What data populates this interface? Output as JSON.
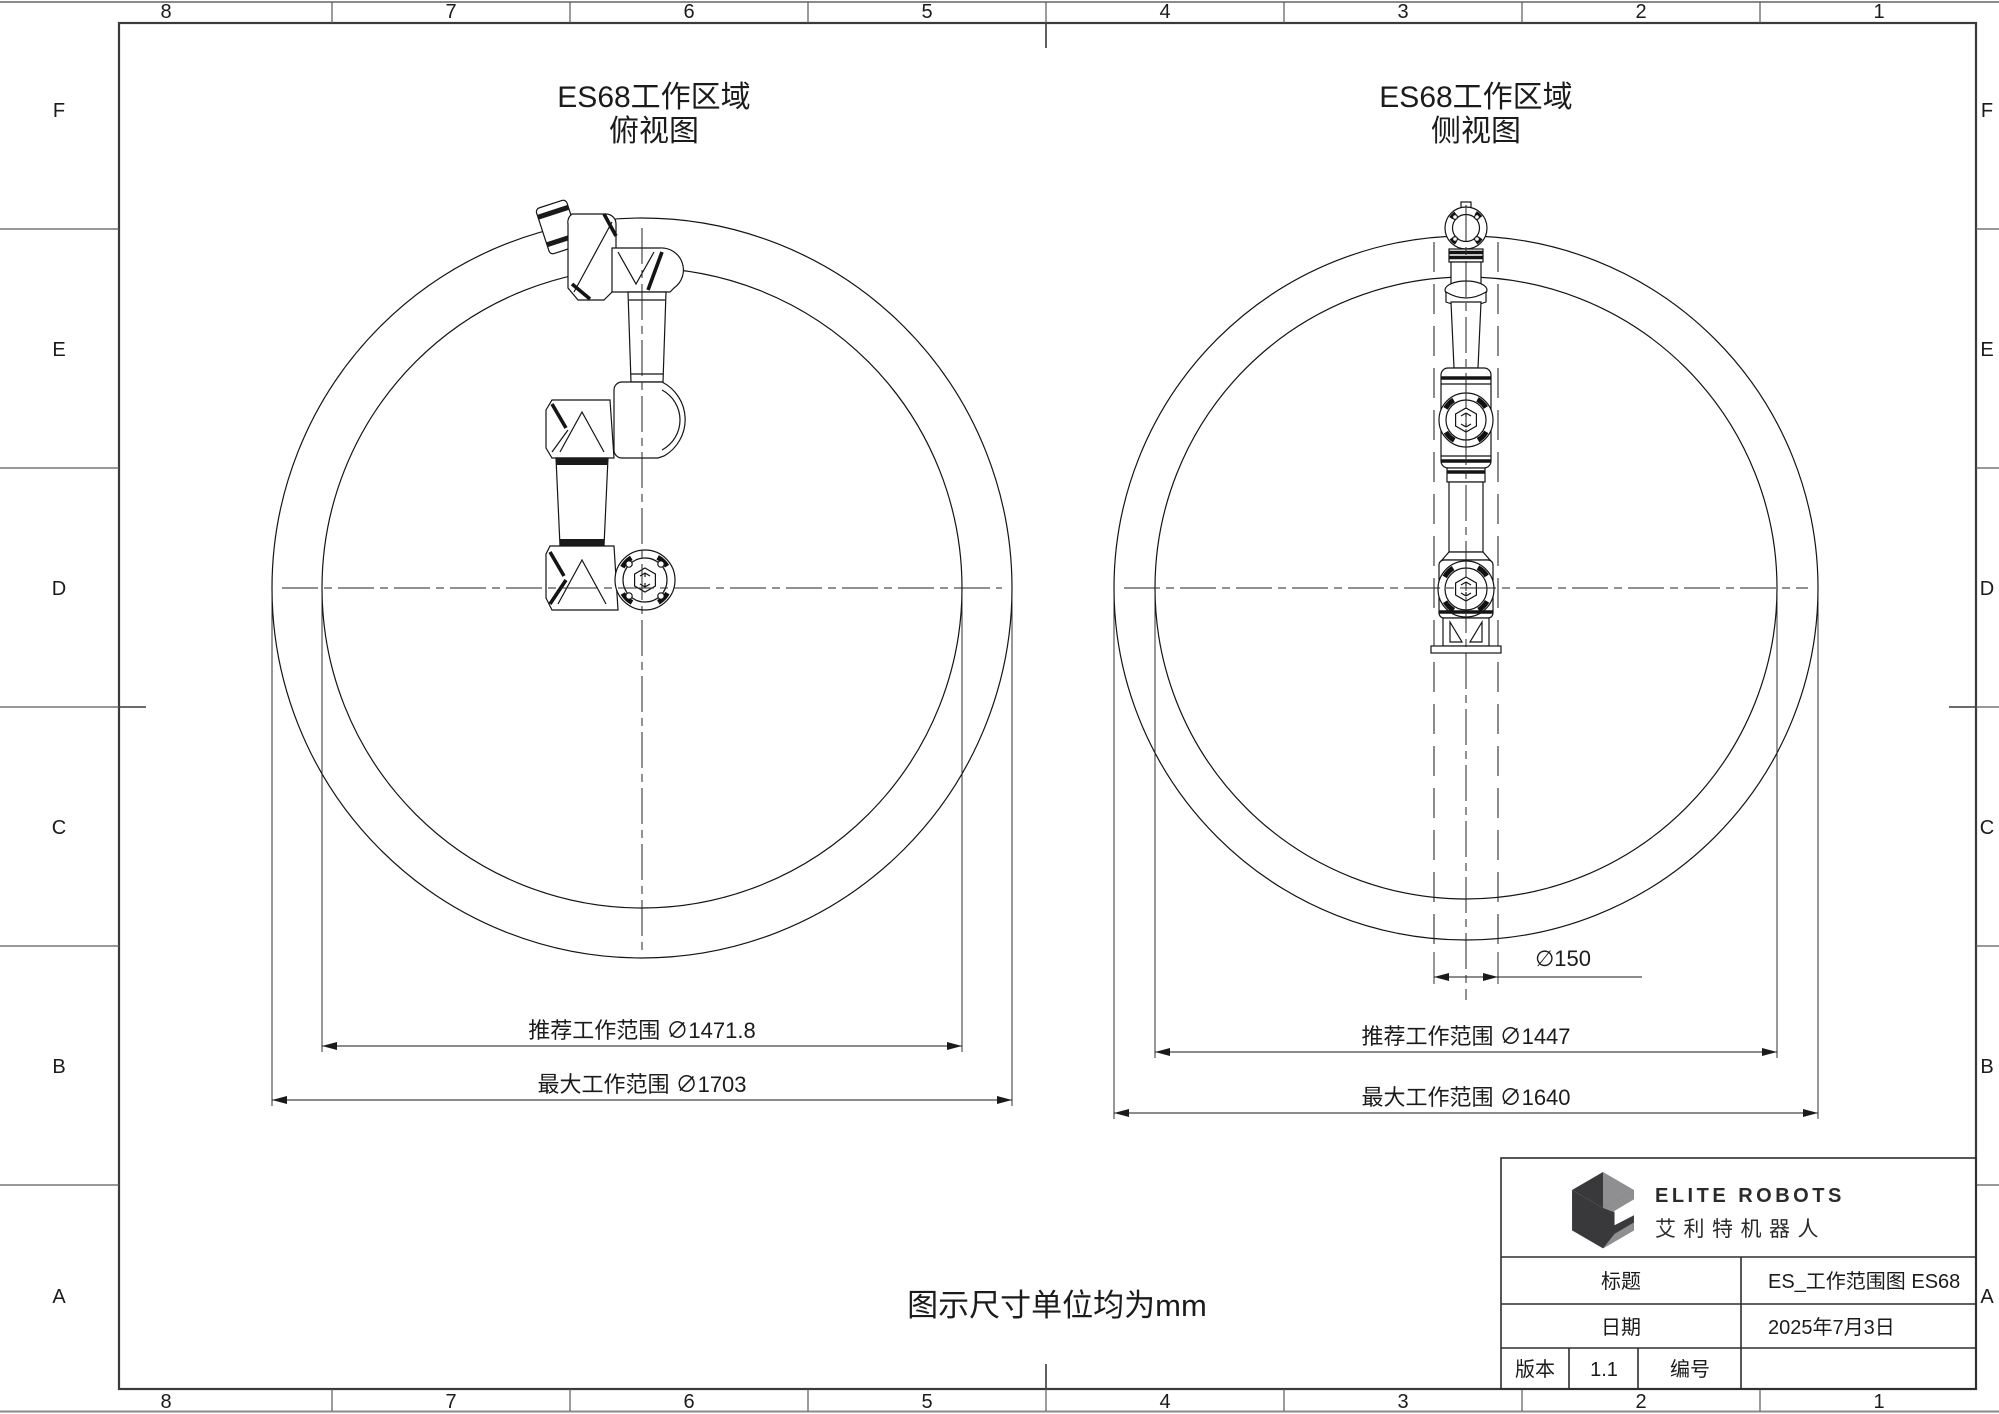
{
  "sheet": {
    "grid": {
      "cols": [
        "8",
        "7",
        "6",
        "5",
        "4",
        "3",
        "2",
        "1"
      ],
      "rows": [
        "F",
        "E",
        "D",
        "C",
        "B",
        "A"
      ]
    },
    "note": "图示尺寸单位均为mm"
  },
  "views": {
    "top_view": {
      "title_line1": "ES68工作区域",
      "title_line2": "俯视图",
      "dim_recommended": "推荐工作范围 ∅1471.8",
      "dim_max": "最大工作范围 ∅1703"
    },
    "side_view": {
      "title_line1": "ES68工作区域",
      "title_line2": "侧视图",
      "dim_column": "∅150",
      "dim_recommended": "推荐工作范围 ∅1447",
      "dim_max": "最大工作范围 ∅1640"
    }
  },
  "title_block": {
    "brand_en": "ELITE ROBOTS",
    "brand_cn": "艾利特机器人",
    "title_label": "标题",
    "title_value": "ES_工作范围图  ES68",
    "date_label": "日期",
    "date_value": "2025年7月3日",
    "version_label": "版本",
    "version_value": "1.1",
    "number_label": "编号",
    "number_value": ""
  },
  "colors": {
    "line": "#141414",
    "frame": "#3a3a3a",
    "logo_dark": "#39393b",
    "logo_gray": "#8f8f91"
  }
}
